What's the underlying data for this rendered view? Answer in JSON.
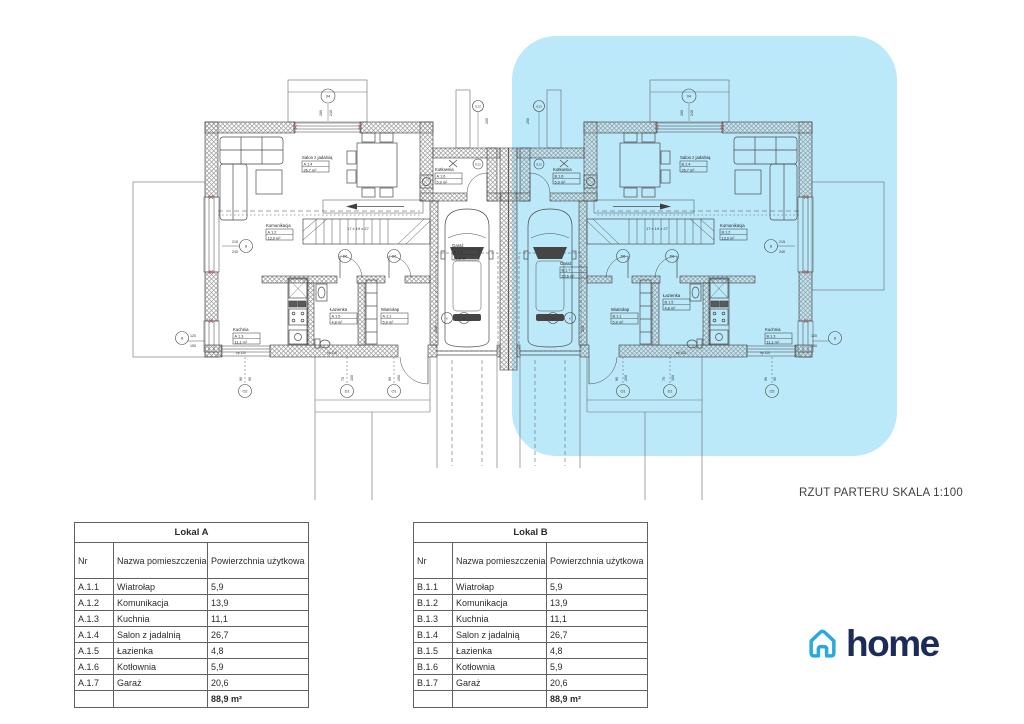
{
  "scale_label": "RZUT PARTERU SKALA 1:100",
  "logo": {
    "text": "home"
  },
  "colors": {
    "highlight": "#bce9fa",
    "line": "#4a4a4a",
    "logo_blue": "#2aa9e0",
    "logo_navy": "#1d2b57"
  },
  "plan": {
    "room_labels": [
      {
        "unit": "A",
        "name": "Salon z jadalnią",
        "id": "A.1.4",
        "area": "26,7 m²",
        "x": 302,
        "y": 159
      },
      {
        "unit": "A",
        "name": "Kotłownia",
        "id": "A.1.6",
        "area": "5,9 m²",
        "x": 435,
        "y": 171
      },
      {
        "unit": "A",
        "name": "Komunikacja",
        "id": "A.1.2",
        "area": "13,9 m²",
        "x": 266,
        "y": 227
      },
      {
        "unit": "A",
        "name": "Garaż",
        "id": "A.1.7",
        "area": "20,6 m²",
        "x": 452,
        "y": 247
      },
      {
        "unit": "A",
        "name": "Kuchnia",
        "id": "A.1.3",
        "area": "11,1 m²",
        "x": 233,
        "y": 331
      },
      {
        "unit": "A",
        "name": "Łazienka",
        "id": "A.1.5",
        "area": "4,8 m²",
        "x": 330,
        "y": 311
      },
      {
        "unit": "A",
        "name": "Wiatrołap",
        "id": "A.1.1",
        "area": "5,9 m²",
        "x": 381,
        "y": 311
      },
      {
        "unit": "B",
        "name": "Salon z jadalnią",
        "id": "B.1.4",
        "area": "26,7 m²",
        "x": 680,
        "y": 159
      },
      {
        "unit": "B",
        "name": "Kotłownia",
        "id": "B.1.6",
        "area": "5,9 m²",
        "x": 553,
        "y": 171
      },
      {
        "unit": "B",
        "name": "Komunikacja",
        "id": "B.1.2",
        "area": "13,9 m²",
        "x": 720,
        "y": 227
      },
      {
        "unit": "B",
        "name": "Garaż",
        "id": "B.1.7",
        "area": "20,6 m²",
        "x": 560,
        "y": 265
      },
      {
        "unit": "B",
        "name": "Kuchnia",
        "id": "B.1.3",
        "area": "11,1 m²",
        "x": 765,
        "y": 331
      },
      {
        "unit": "B",
        "name": "Łazienka",
        "id": "B.1.5",
        "area": "4,8 m²",
        "x": 663,
        "y": 297
      },
      {
        "unit": "B",
        "name": "Wiatrołap",
        "id": "B.1.1",
        "area": "5,9 m²",
        "x": 611,
        "y": 311
      }
    ],
    "annotations": [
      {
        "t": "215",
        "x": 238,
        "y": 243,
        "a": "end"
      },
      {
        "t": "240",
        "x": 238,
        "y": 253,
        "a": "end"
      },
      {
        "t": "215",
        "x": 779,
        "y": 243
      },
      {
        "t": "240",
        "x": 779,
        "y": 253
      },
      {
        "t": "120",
        "x": 190,
        "y": 337
      },
      {
        "t": "150",
        "x": 190,
        "y": 347
      },
      {
        "t": "120",
        "x": 811,
        "y": 337
      },
      {
        "t": "150",
        "x": 811,
        "y": 347
      },
      {
        "t": "17 x 19 x 27",
        "x": 347,
        "y": 230,
        "s": 4
      },
      {
        "t": "17 x 19 x 27",
        "x": 646,
        "y": 230,
        "s": 4
      },
      {
        "t": "260",
        "x": 322,
        "y": 116,
        "rot": -90
      },
      {
        "t": "240",
        "x": 332,
        "y": 116,
        "rot": -90
      },
      {
        "t": "260",
        "x": 683,
        "y": 116,
        "rot": -90
      },
      {
        "t": "240",
        "x": 693,
        "y": 116,
        "rot": -90
      },
      {
        "t": "200",
        "x": 488,
        "y": 124,
        "rot": -90
      },
      {
        "t": "200",
        "x": 529,
        "y": 124,
        "rot": -90
      },
      {
        "t": "hp 110",
        "x": 236,
        "y": 354,
        "s": 3.3
      },
      {
        "t": "hp 110",
        "x": 327,
        "y": 354,
        "s": 3.3
      },
      {
        "t": "hp 110",
        "x": 760,
        "y": 354,
        "s": 3.3
      },
      {
        "t": "hp 110",
        "x": 676,
        "y": 354,
        "s": 3.3
      },
      {
        "t": "90",
        "x": 242,
        "y": 381,
        "rot": -90
      },
      {
        "t": "90",
        "x": 251,
        "y": 381,
        "rot": -90
      },
      {
        "t": "70",
        "x": 344,
        "y": 381,
        "rot": -90
      },
      {
        "t": "100",
        "x": 353,
        "y": 381,
        "rot": -90
      },
      {
        "t": "90",
        "x": 391,
        "y": 381,
        "rot": -90
      },
      {
        "t": "200",
        "x": 400,
        "y": 381,
        "rot": -90
      },
      {
        "t": "90",
        "x": 767,
        "y": 381,
        "rot": -90
      },
      {
        "t": "90",
        "x": 776,
        "y": 381,
        "rot": -90
      },
      {
        "t": "70",
        "x": 665,
        "y": 381,
        "rot": -90
      },
      {
        "t": "100",
        "x": 674,
        "y": 381,
        "rot": -90
      },
      {
        "t": "90",
        "x": 618,
        "y": 381,
        "rot": -90
      },
      {
        "t": "200",
        "x": 627,
        "y": 381,
        "rot": -90
      },
      {
        "t": "200",
        "x": 437,
        "y": 332,
        "rot": -90
      },
      {
        "t": "200",
        "x": 584,
        "y": 332,
        "rot": -90
      }
    ],
    "markers": [
      {
        "l": "04",
        "x": 328,
        "y": 96,
        "r": 7
      },
      {
        "l": "04",
        "x": 689,
        "y": 96,
        "r": 7
      },
      {
        "l": "E13",
        "x": 478,
        "y": 106,
        "r": 5.5
      },
      {
        "l": "E13",
        "x": 539,
        "y": 106,
        "r": 5.5
      },
      {
        "l": "E13",
        "x": 478,
        "y": 164,
        "r": 5
      },
      {
        "l": "E13",
        "x": 539,
        "y": 164,
        "r": 5
      },
      {
        "l": "8",
        "x": 246,
        "y": 246,
        "r": 6.5
      },
      {
        "l": "8",
        "x": 771,
        "y": 246,
        "r": 6.5
      },
      {
        "l": "8",
        "x": 182,
        "y": 338,
        "r": 6.5
      },
      {
        "l": "8",
        "x": 835,
        "y": 338,
        "r": 6.5
      },
      {
        "l": "D6",
        "x": 345,
        "y": 256,
        "r": 6.5
      },
      {
        "l": "D6",
        "x": 394,
        "y": 256,
        "r": 6.5
      },
      {
        "l": "D6",
        "x": 623,
        "y": 256,
        "r": 6.5
      },
      {
        "l": "D6",
        "x": 672,
        "y": 256,
        "r": 6.5
      },
      {
        "l": "K",
        "x": 447,
        "y": 318,
        "r": 5.5
      },
      {
        "l": "DG",
        "x": 464,
        "y": 318,
        "r": 5.5
      },
      {
        "l": "DG",
        "x": 553,
        "y": 318,
        "r": 5.5
      },
      {
        "l": "K",
        "x": 570,
        "y": 318,
        "r": 5.5
      },
      {
        "l": "O2",
        "x": 245,
        "y": 391,
        "r": 6.5
      },
      {
        "l": "D1",
        "x": 347,
        "y": 391,
        "r": 6.5
      },
      {
        "l": "O1",
        "x": 394,
        "y": 391,
        "r": 6.5
      },
      {
        "l": "O1",
        "x": 623,
        "y": 391,
        "r": 6.5
      },
      {
        "l": "D1",
        "x": 670,
        "y": 391,
        "r": 6.5
      },
      {
        "l": "O2",
        "x": 772,
        "y": 391,
        "r": 6.5
      }
    ]
  },
  "tables": [
    {
      "title": "Lokal A",
      "headers": [
        "Nr",
        "Nazwa pomieszczenia",
        "Powierzchnia użytkowa"
      ],
      "rows": [
        [
          "A.1.1",
          "Wiatrołap",
          "5,9"
        ],
        [
          "A.1.2",
          "Komunikacja",
          "13,9"
        ],
        [
          "A.1.3",
          "Kuchnia",
          "11,1"
        ],
        [
          "A.1.4",
          "Salon z jadalnią",
          "26,7"
        ],
        [
          "A.1.5",
          "Łazienka",
          "4,8"
        ],
        [
          "A.1.6",
          "Kotłownia",
          "5,9"
        ],
        [
          "A.1.7",
          "Garaż",
          "20,6"
        ]
      ],
      "total": "88,9 m²"
    },
    {
      "title": "Lokal B",
      "headers": [
        "Nr",
        "Nazwa pomieszczenia",
        "Powierzchnia użytkowa"
      ],
      "rows": [
        [
          "B.1.1",
          "Wiatrołap",
          "5,9"
        ],
        [
          "B.1.2",
          "Komunikacja",
          "13,9"
        ],
        [
          "B.1.3",
          "Kuchnia",
          "11,1"
        ],
        [
          "B.1.4",
          "Salon z jadalnią",
          "26,7"
        ],
        [
          "B.1.5",
          "Łazienka",
          "4,8"
        ],
        [
          "B.1.6",
          "Kotłownia",
          "5,9"
        ],
        [
          "B.1.7",
          "Garaż",
          "20,6"
        ]
      ],
      "total": "88,9 m²"
    }
  ]
}
